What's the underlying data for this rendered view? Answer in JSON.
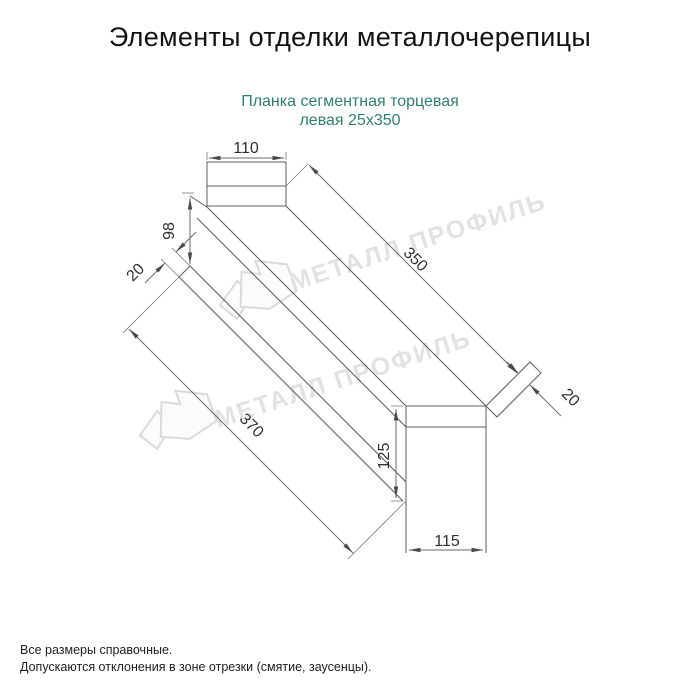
{
  "header": {
    "title": "Элементы отделки металлочерепицы"
  },
  "product": {
    "name_line1": "Планка сегментная торцевая",
    "name_line2": "левая 25х350"
  },
  "dimensions": {
    "top_tab_width": "110",
    "end_height": "98",
    "left_hem": "20",
    "length_top": "350",
    "length_bottom": "370",
    "right_hem": "20",
    "bottom_tab_height": "125",
    "bottom_tab_width": "115"
  },
  "watermark": {
    "brand": "МЕТАЛЛ ПРОФИЛЬ"
  },
  "footer": {
    "note1": "Все размеры справочные.",
    "note2": "Допускаются отклонения в зоне отрезки (смятие, заусенцы)."
  },
  "colors": {
    "subtitle": "#2e8070",
    "drawing_line": "#5c5c5c",
    "dimension_text": "#2f2f2f",
    "watermark": "#e2e2e2",
    "title_text": "#121212"
  }
}
